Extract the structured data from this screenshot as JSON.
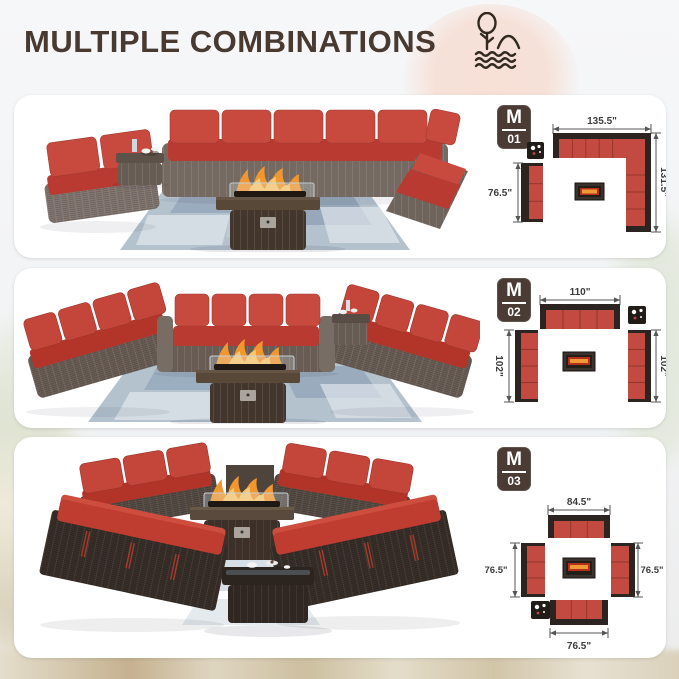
{
  "header": {
    "title": "MULTIPLE COMBINATIONS",
    "icon": "lake-tree-scene-icon"
  },
  "panels": [
    {
      "badge": {
        "letter": "M",
        "number": "01"
      },
      "dims": {
        "top": "135.5\"",
        "left": "76.5\"",
        "right": "131.5\""
      }
    },
    {
      "badge": {
        "letter": "M",
        "number": "02"
      },
      "dims": {
        "top": "110\"",
        "left": "102\"",
        "right": "102\""
      }
    },
    {
      "badge": {
        "letter": "M",
        "number": "03"
      },
      "dims": {
        "top": "84.5\"",
        "left": "76.5\"",
        "right": "76.5\"",
        "bottom": "76.5\""
      }
    }
  ],
  "colors": {
    "title_brown": "#483931",
    "badge_bg": "#4a3b34",
    "cushion_red": "#c24a40",
    "frame_dark": "#2b2420",
    "wicker_gray_brown": "#7f746c",
    "rug_blue": "#b4c2ce",
    "flame_orange": "#f2972f",
    "peach_blob": "#f7e0d6"
  }
}
